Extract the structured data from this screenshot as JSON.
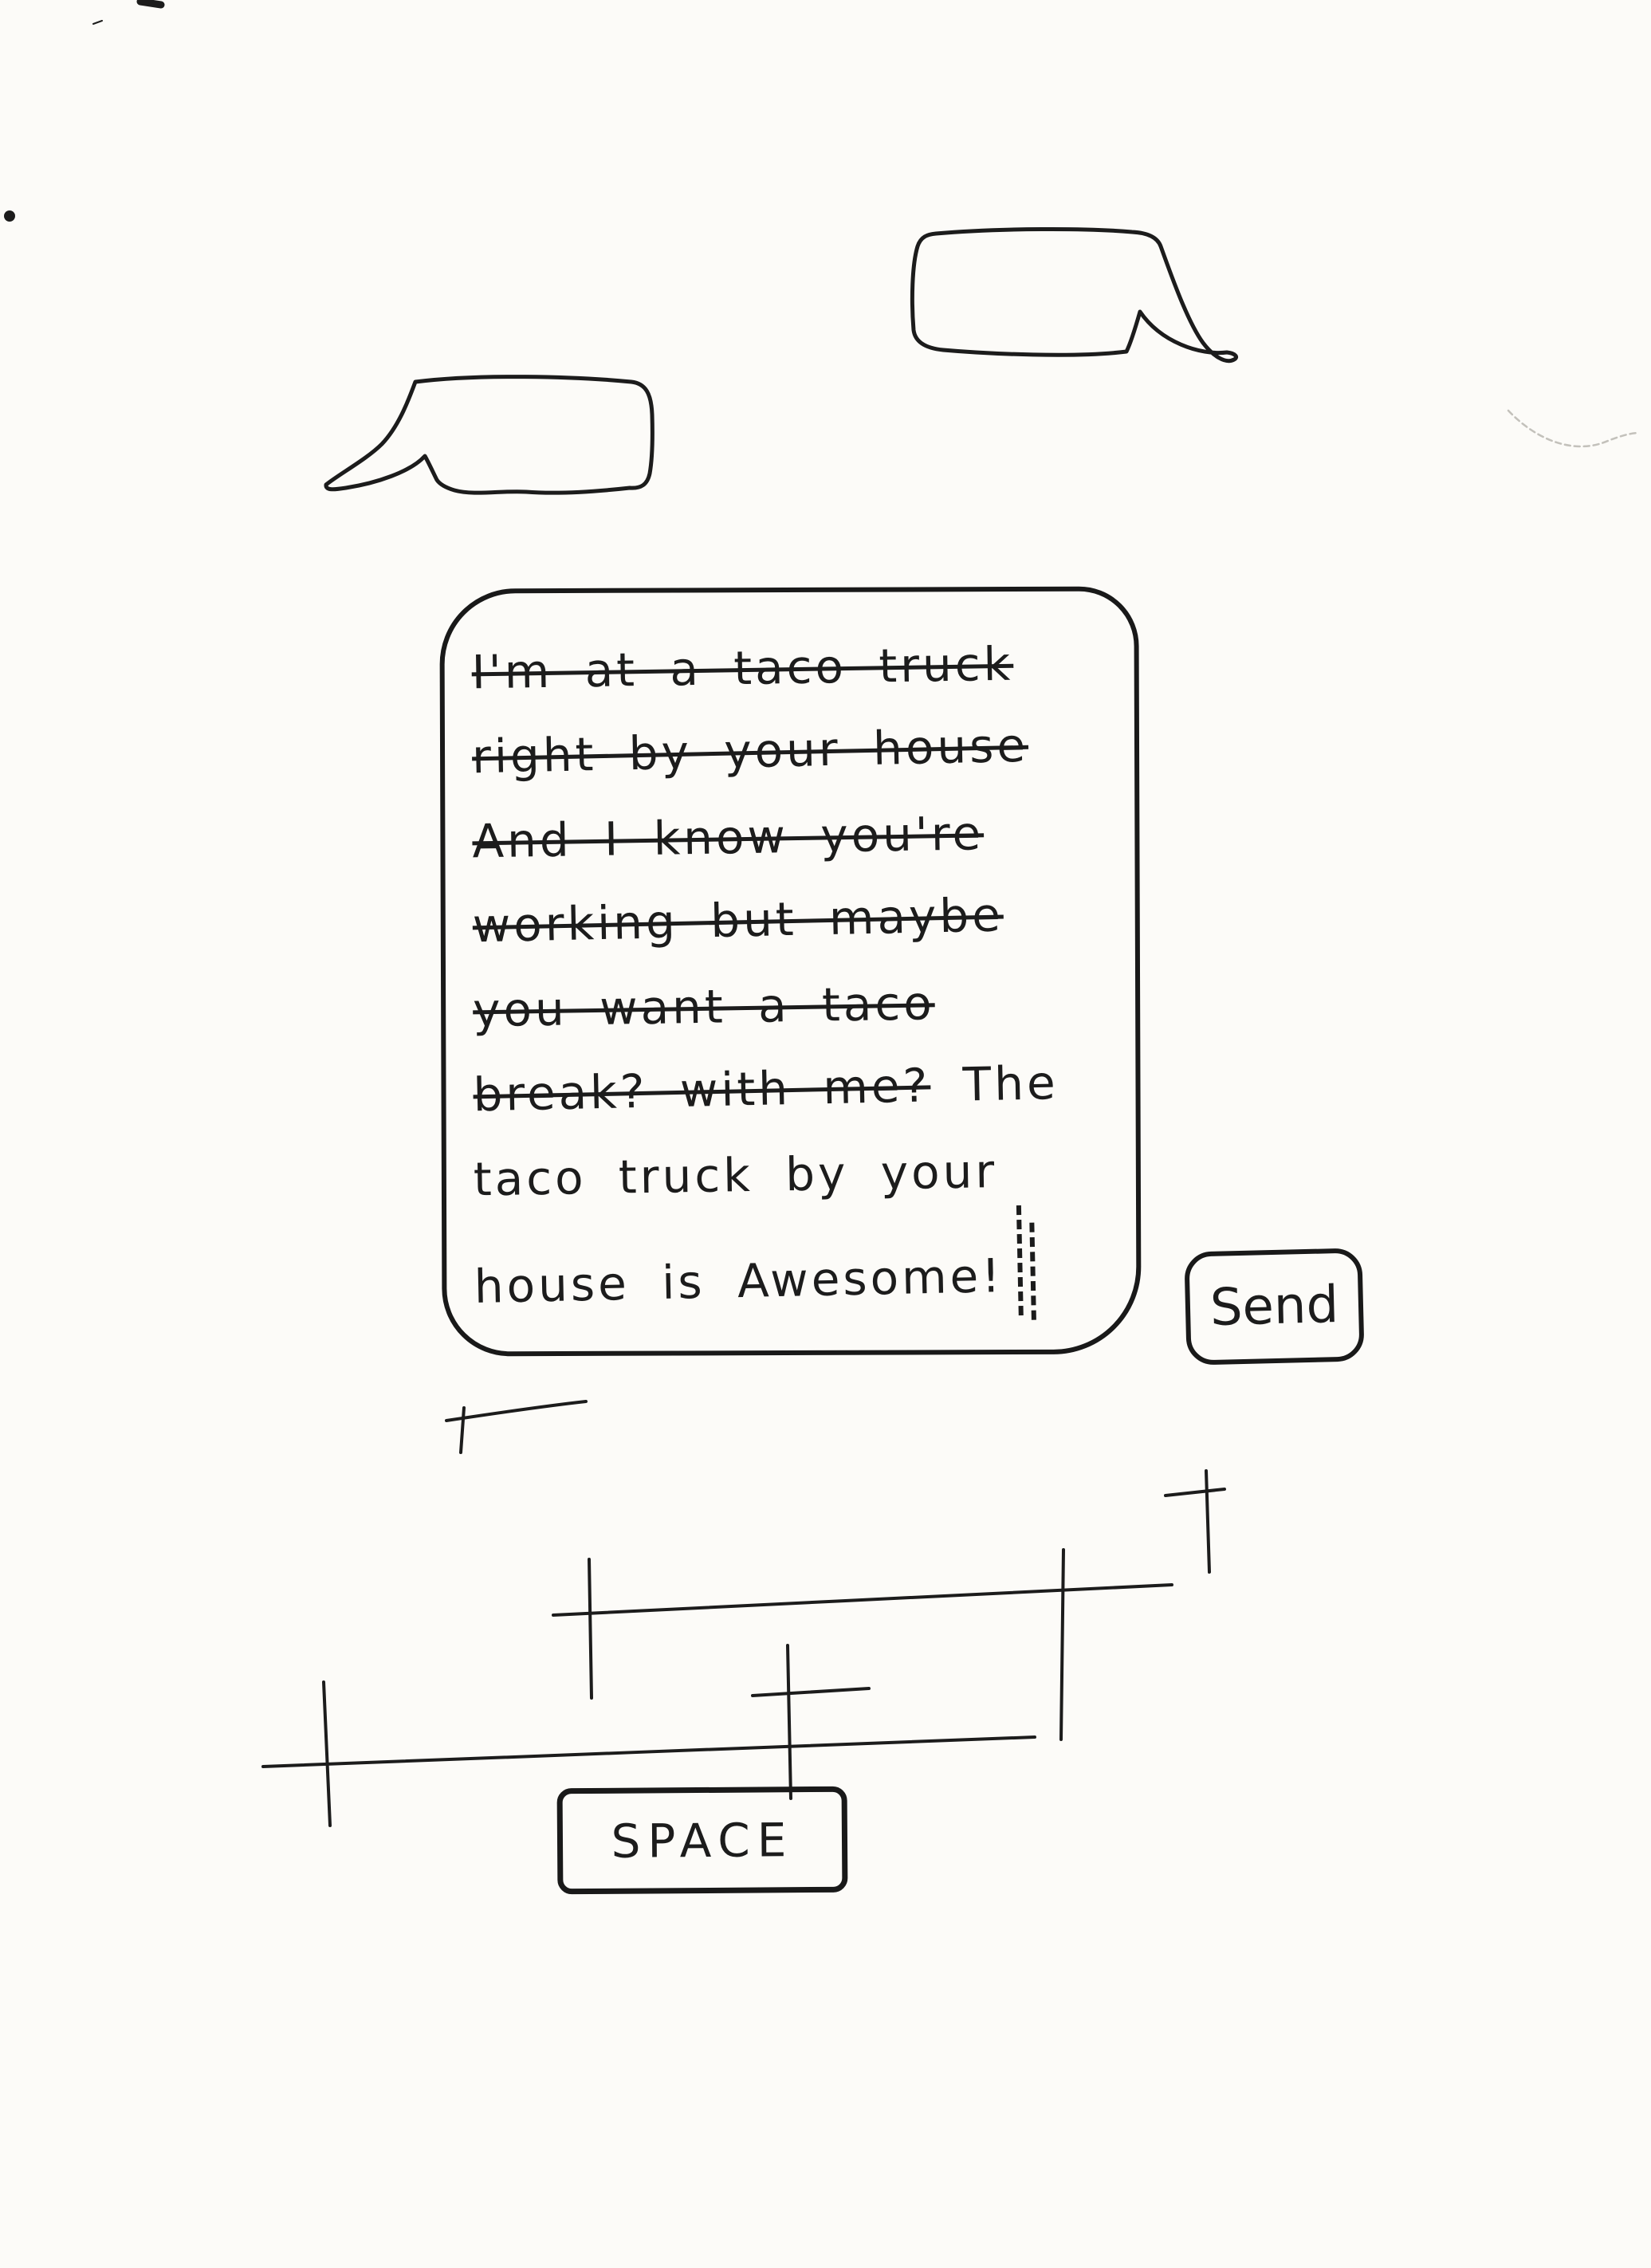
{
  "page": {
    "background_color": "#fcfbf8",
    "ink_color": "#1c1c1c"
  },
  "chat": {
    "bubble_top_right": {
      "text": ""
    },
    "bubble_left": {
      "text": ""
    }
  },
  "composer": {
    "lines": [
      {
        "struck": "I'm at a taco truck",
        "plain": ""
      },
      {
        "struck": "right by your house",
        "plain": ""
      },
      {
        "struck": "And I know you're",
        "plain": ""
      },
      {
        "struck": "working but maybe",
        "plain": ""
      },
      {
        "struck": "you want a taco",
        "plain": ""
      },
      {
        "struck": "break? with me?",
        "plain": " The"
      },
      {
        "struck": "",
        "plain": "taco truck by your"
      },
      {
        "struck": "",
        "plain": "house is Awesome!"
      }
    ]
  },
  "send_button": {
    "label": "Send"
  },
  "keyboard": {
    "space_key": {
      "label": "SPACE"
    }
  }
}
